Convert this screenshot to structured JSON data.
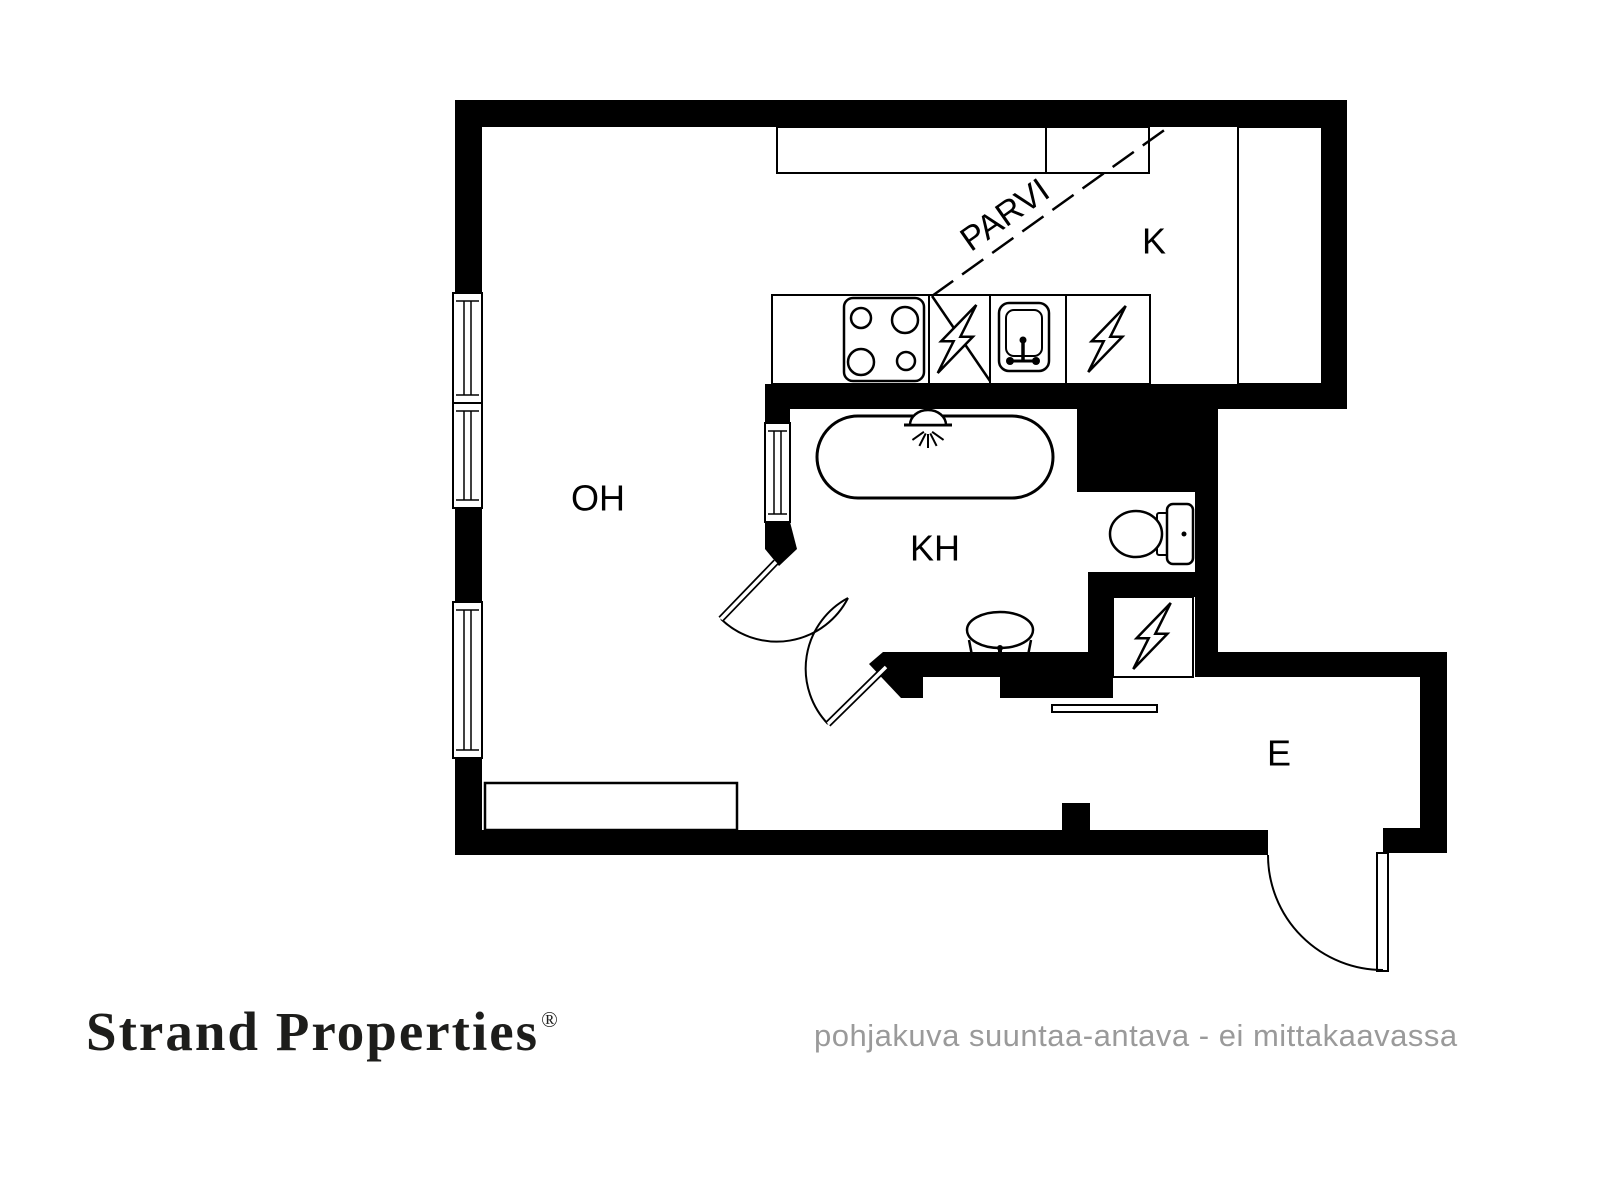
{
  "branding": {
    "logo_text": "Strand Properties",
    "registered_mark": "®",
    "disclaimer": "pohjakuva suuntaa-antava - ei mittakaavassa",
    "logo_color": "#1d1d1b",
    "disclaimer_color": "#9a9a9a"
  },
  "plan": {
    "ink": "#000000",
    "paper": "#ffffff",
    "wall_rects": [
      {
        "name": "wall-top",
        "r": [
          455,
          100,
          892,
          27
        ]
      },
      {
        "name": "wall-left-upper",
        "r": [
          455,
          100,
          27,
          193
        ]
      },
      {
        "name": "wall-left-middle",
        "r": [
          455,
          508,
          27,
          94
        ]
      },
      {
        "name": "wall-left-lower",
        "r": [
          455,
          758,
          27,
          97
        ]
      },
      {
        "name": "wall-bottom",
        "r": [
          455,
          830,
          813,
          25
        ]
      },
      {
        "name": "wall-bottom-stub",
        "r": [
          1062,
          803,
          28,
          27
        ]
      },
      {
        "name": "wall-bottom-right-corner",
        "r": [
          1383,
          828,
          64,
          25
        ]
      },
      {
        "name": "wall-entry-right",
        "r": [
          1420,
          675,
          27,
          178
        ]
      },
      {
        "name": "wall-entry-top",
        "r": [
          1218,
          652,
          229,
          25
        ]
      },
      {
        "name": "wall-kitchen-right",
        "r": [
          1322,
          100,
          25,
          309
        ]
      },
      {
        "name": "wall-kitchen-bathroom",
        "r": [
          765,
          384,
          582,
          25
        ]
      },
      {
        "name": "wall-bathroom-left-upper",
        "r": [
          765,
          409,
          25,
          15
        ]
      },
      {
        "name": "wall-bathroom-right-block",
        "r": [
          1077,
          409,
          141,
          83
        ]
      },
      {
        "name": "wall-toilet-right",
        "r": [
          1195,
          492,
          23,
          185
        ]
      },
      {
        "name": "wall-toilet-niche-bottom",
        "r": [
          1088,
          572,
          130,
          25
        ]
      },
      {
        "name": "wall-utility-left",
        "r": [
          1088,
          597,
          25,
          101
        ]
      },
      {
        "name": "wall-bathroom-bottom",
        "r": [
          923,
          652,
          165,
          25
        ]
      },
      {
        "name": "wall-bathroom-bottom-step",
        "r": [
          1000,
          673,
          113,
          25
        ]
      }
    ],
    "wall_polygons": [
      {
        "name": "wall-bathroom-door-jamb",
        "pts": [
          [
            765,
            522
          ],
          [
            790,
            522
          ],
          [
            797,
            549
          ],
          [
            779,
            566
          ],
          [
            765,
            549
          ]
        ]
      },
      {
        "name": "wall-bathroom-diagonal",
        "pts": [
          [
            883,
            652
          ],
          [
            923,
            652
          ],
          [
            923,
            698
          ],
          [
            901,
            698
          ],
          [
            869,
            664
          ]
        ]
      }
    ],
    "windows": [
      {
        "name": "window-left-1",
        "r": [
          453,
          293,
          29,
          110
        ]
      },
      {
        "name": "window-left-2",
        "r": [
          453,
          403,
          29,
          105
        ]
      },
      {
        "name": "window-left-3",
        "r": [
          453,
          602,
          29,
          156
        ]
      },
      {
        "name": "window-bathroom",
        "r": [
          765,
          423,
          25,
          99
        ]
      }
    ],
    "fixture_rects": [
      {
        "name": "kitchen-upper-cabinet",
        "r": [
          777,
          127,
          372,
          46
        ],
        "rx": 0,
        "sw": 2
      },
      {
        "name": "kitchen-tall-cabinet",
        "r": [
          1238,
          127,
          84,
          257
        ],
        "rx": 0,
        "sw": 2
      },
      {
        "name": "kitchen-counter",
        "r": [
          772,
          295,
          378,
          89
        ],
        "rx": 0,
        "sw": 2
      },
      {
        "name": "stove",
        "r": [
          844,
          298,
          80,
          83
        ],
        "rx": 9,
        "sw": 2.5
      },
      {
        "name": "kitchen-sink-outer",
        "r": [
          999,
          303,
          50,
          68
        ],
        "rx": 10,
        "sw": 2.5
      },
      {
        "name": "kitchen-sink-basin",
        "r": [
          1006,
          310,
          36,
          46
        ],
        "rx": 8,
        "sw": 2
      },
      {
        "name": "bathtub",
        "r": [
          817,
          416,
          236,
          82
        ],
        "rx": 41,
        "sw": 3
      },
      {
        "name": "toilet-connector",
        "r": [
          1157,
          513,
          12,
          42
        ],
        "rx": 2,
        "sw": 2
      },
      {
        "name": "toilet-tank",
        "r": [
          1167,
          504,
          26,
          60
        ],
        "rx": 6,
        "sw": 2.5
      },
      {
        "name": "utility-cabinet",
        "r": [
          1113,
          597,
          80,
          80
        ],
        "rx": 0,
        "sw": 2
      },
      {
        "name": "entry-shelf",
        "r": [
          1052,
          705,
          105,
          7
        ],
        "rx": 0,
        "sw": 2
      },
      {
        "name": "living-room-cabinet",
        "r": [
          485,
          783,
          252,
          47
        ],
        "rx": 0,
        "sw": 2.5
      },
      {
        "name": "entry-door-leaf",
        "r": [
          1377,
          853,
          11,
          118
        ],
        "rx": 0,
        "sw": 2
      }
    ],
    "lines": [
      {
        "name": "cabinet-divider",
        "p": [
          1046,
          127,
          1046,
          173
        ],
        "sw": 2
      },
      {
        "name": "counter-divider-1",
        "p": [
          929,
          295,
          929,
          384
        ],
        "sw": 2
      },
      {
        "name": "counter-divider-2",
        "p": [
          990,
          295,
          990,
          384
        ],
        "sw": 2
      },
      {
        "name": "counter-divider-3",
        "p": [
          1066,
          295,
          1066,
          384
        ],
        "sw": 2
      },
      {
        "name": "loft-edge-solid",
        "p": [
          932,
          296,
          990,
          381
        ],
        "sw": 2.5
      },
      {
        "name": "shower-base",
        "p": [
          904,
          425,
          952,
          425
        ],
        "sw": 3
      },
      {
        "name": "kitchen-faucet-stem",
        "p": [
          1023,
          341,
          1023,
          361
        ],
        "sw": 3.5
      },
      {
        "name": "kitchen-faucet-bar",
        "p": [
          1009,
          361,
          1037,
          361
        ],
        "sw": 3
      },
      {
        "name": "bathroom-sink-left",
        "p": [
          969,
          640,
          975,
          671
        ],
        "sw": 2.5
      },
      {
        "name": "bathroom-sink-right",
        "p": [
          1031,
          640,
          1025,
          671
        ],
        "sw": 2.5
      },
      {
        "name": "bathroom-sink-bottom",
        "p": [
          975,
          671,
          1025,
          671
        ],
        "sw": 2.5
      },
      {
        "name": "bathroom-faucet-stem",
        "p": [
          1000,
          650,
          1000,
          666
        ],
        "sw": 4
      }
    ],
    "loft_dashed_line": {
      "p": [
        932,
        296,
        1170,
        126
      ],
      "sw": 2.5,
      "dash": "26 11"
    },
    "stroke_circles": [
      {
        "name": "stove-burner",
        "c": [
          861,
          318,
          10
        ]
      },
      {
        "name": "stove-burner",
        "c": [
          905,
          320,
          13
        ]
      },
      {
        "name": "stove-burner",
        "c": [
          861,
          362,
          13
        ]
      },
      {
        "name": "stove-burner",
        "c": [
          906,
          361,
          9
        ]
      }
    ],
    "fill_circles": [
      {
        "name": "kitchen-faucet-knob",
        "c": [
          1023,
          340,
          3.5
        ]
      },
      {
        "name": "kitchen-faucet-dot",
        "c": [
          1010,
          361,
          4
        ]
      },
      {
        "name": "kitchen-faucet-dot",
        "c": [
          1036,
          361,
          4
        ]
      },
      {
        "name": "toilet-flush-button",
        "c": [
          1184,
          534,
          2.5
        ]
      },
      {
        "name": "bathroom-faucet-knob",
        "c": [
          1000,
          648,
          3
        ]
      },
      {
        "name": "bathroom-faucet-dot",
        "c": [
          989,
          664,
          4
        ]
      },
      {
        "name": "bathroom-faucet-dot",
        "c": [
          1011,
          664,
          4
        ]
      }
    ],
    "ellipses": [
      {
        "name": "toilet-bowl",
        "e": [
          1136,
          534,
          26,
          23
        ],
        "sw": 2.5
      },
      {
        "name": "bathroom-sink-bowl",
        "e": [
          1000,
          630,
          33,
          18
        ],
        "sw": 2.5
      }
    ],
    "shower": {
      "dome": "M910,425 A18,15 0 0 1 946,425 Z",
      "dome_sw": 2.5,
      "spray": {
        "cx": 928,
        "cy": 429,
        "r0": 5,
        "r1": 19,
        "angles": [
          -55,
          -27,
          0,
          27,
          55
        ],
        "sw": 2
      }
    },
    "lightning_bolts": [
      {
        "name": "electric-appliance-bolt",
        "c": [
          957,
          339
        ],
        "h": 68
      },
      {
        "name": "electric-appliance-bolt",
        "c": [
          1107,
          339
        ],
        "h": 66
      },
      {
        "name": "electric-panel-bolt",
        "c": [
          1152,
          636
        ],
        "h": 66
      }
    ],
    "door_arcs": [
      {
        "name": "door-swing-bathroom-outer",
        "d": "M721,619 A80,80 0 0 0 848,598",
        "sw": 2
      },
      {
        "name": "door-swing-bathroom-inner",
        "d": "M848,598 A80,80 0 0 0 828,724",
        "sw": 2
      },
      {
        "name": "door-swing-entry",
        "d": "M1268,855 A115,115 0 0 0 1383,970",
        "sw": 2
      }
    ],
    "door_leaves": [
      {
        "name": "door-leaf-bathroom-outer",
        "p": [
          776,
          562,
          721,
          619
        ]
      },
      {
        "name": "door-leaf-bathroom-inner",
        "p": [
          886,
          667,
          828,
          724
        ]
      }
    ],
    "room_labels": [
      {
        "id": "living-room",
        "text": "OH",
        "x": 598,
        "y": 498,
        "size": 36
      },
      {
        "id": "kitchen",
        "text": "K",
        "x": 1154,
        "y": 241,
        "size": 36
      },
      {
        "id": "bathroom",
        "text": "KH",
        "x": 935,
        "y": 548,
        "size": 36
      },
      {
        "id": "entry",
        "text": "E",
        "x": 1279,
        "y": 753,
        "size": 36
      }
    ],
    "loft_label": {
      "text": "PARVI",
      "x": 1005,
      "y": 215,
      "size": 34,
      "rotation": -35
    }
  }
}
